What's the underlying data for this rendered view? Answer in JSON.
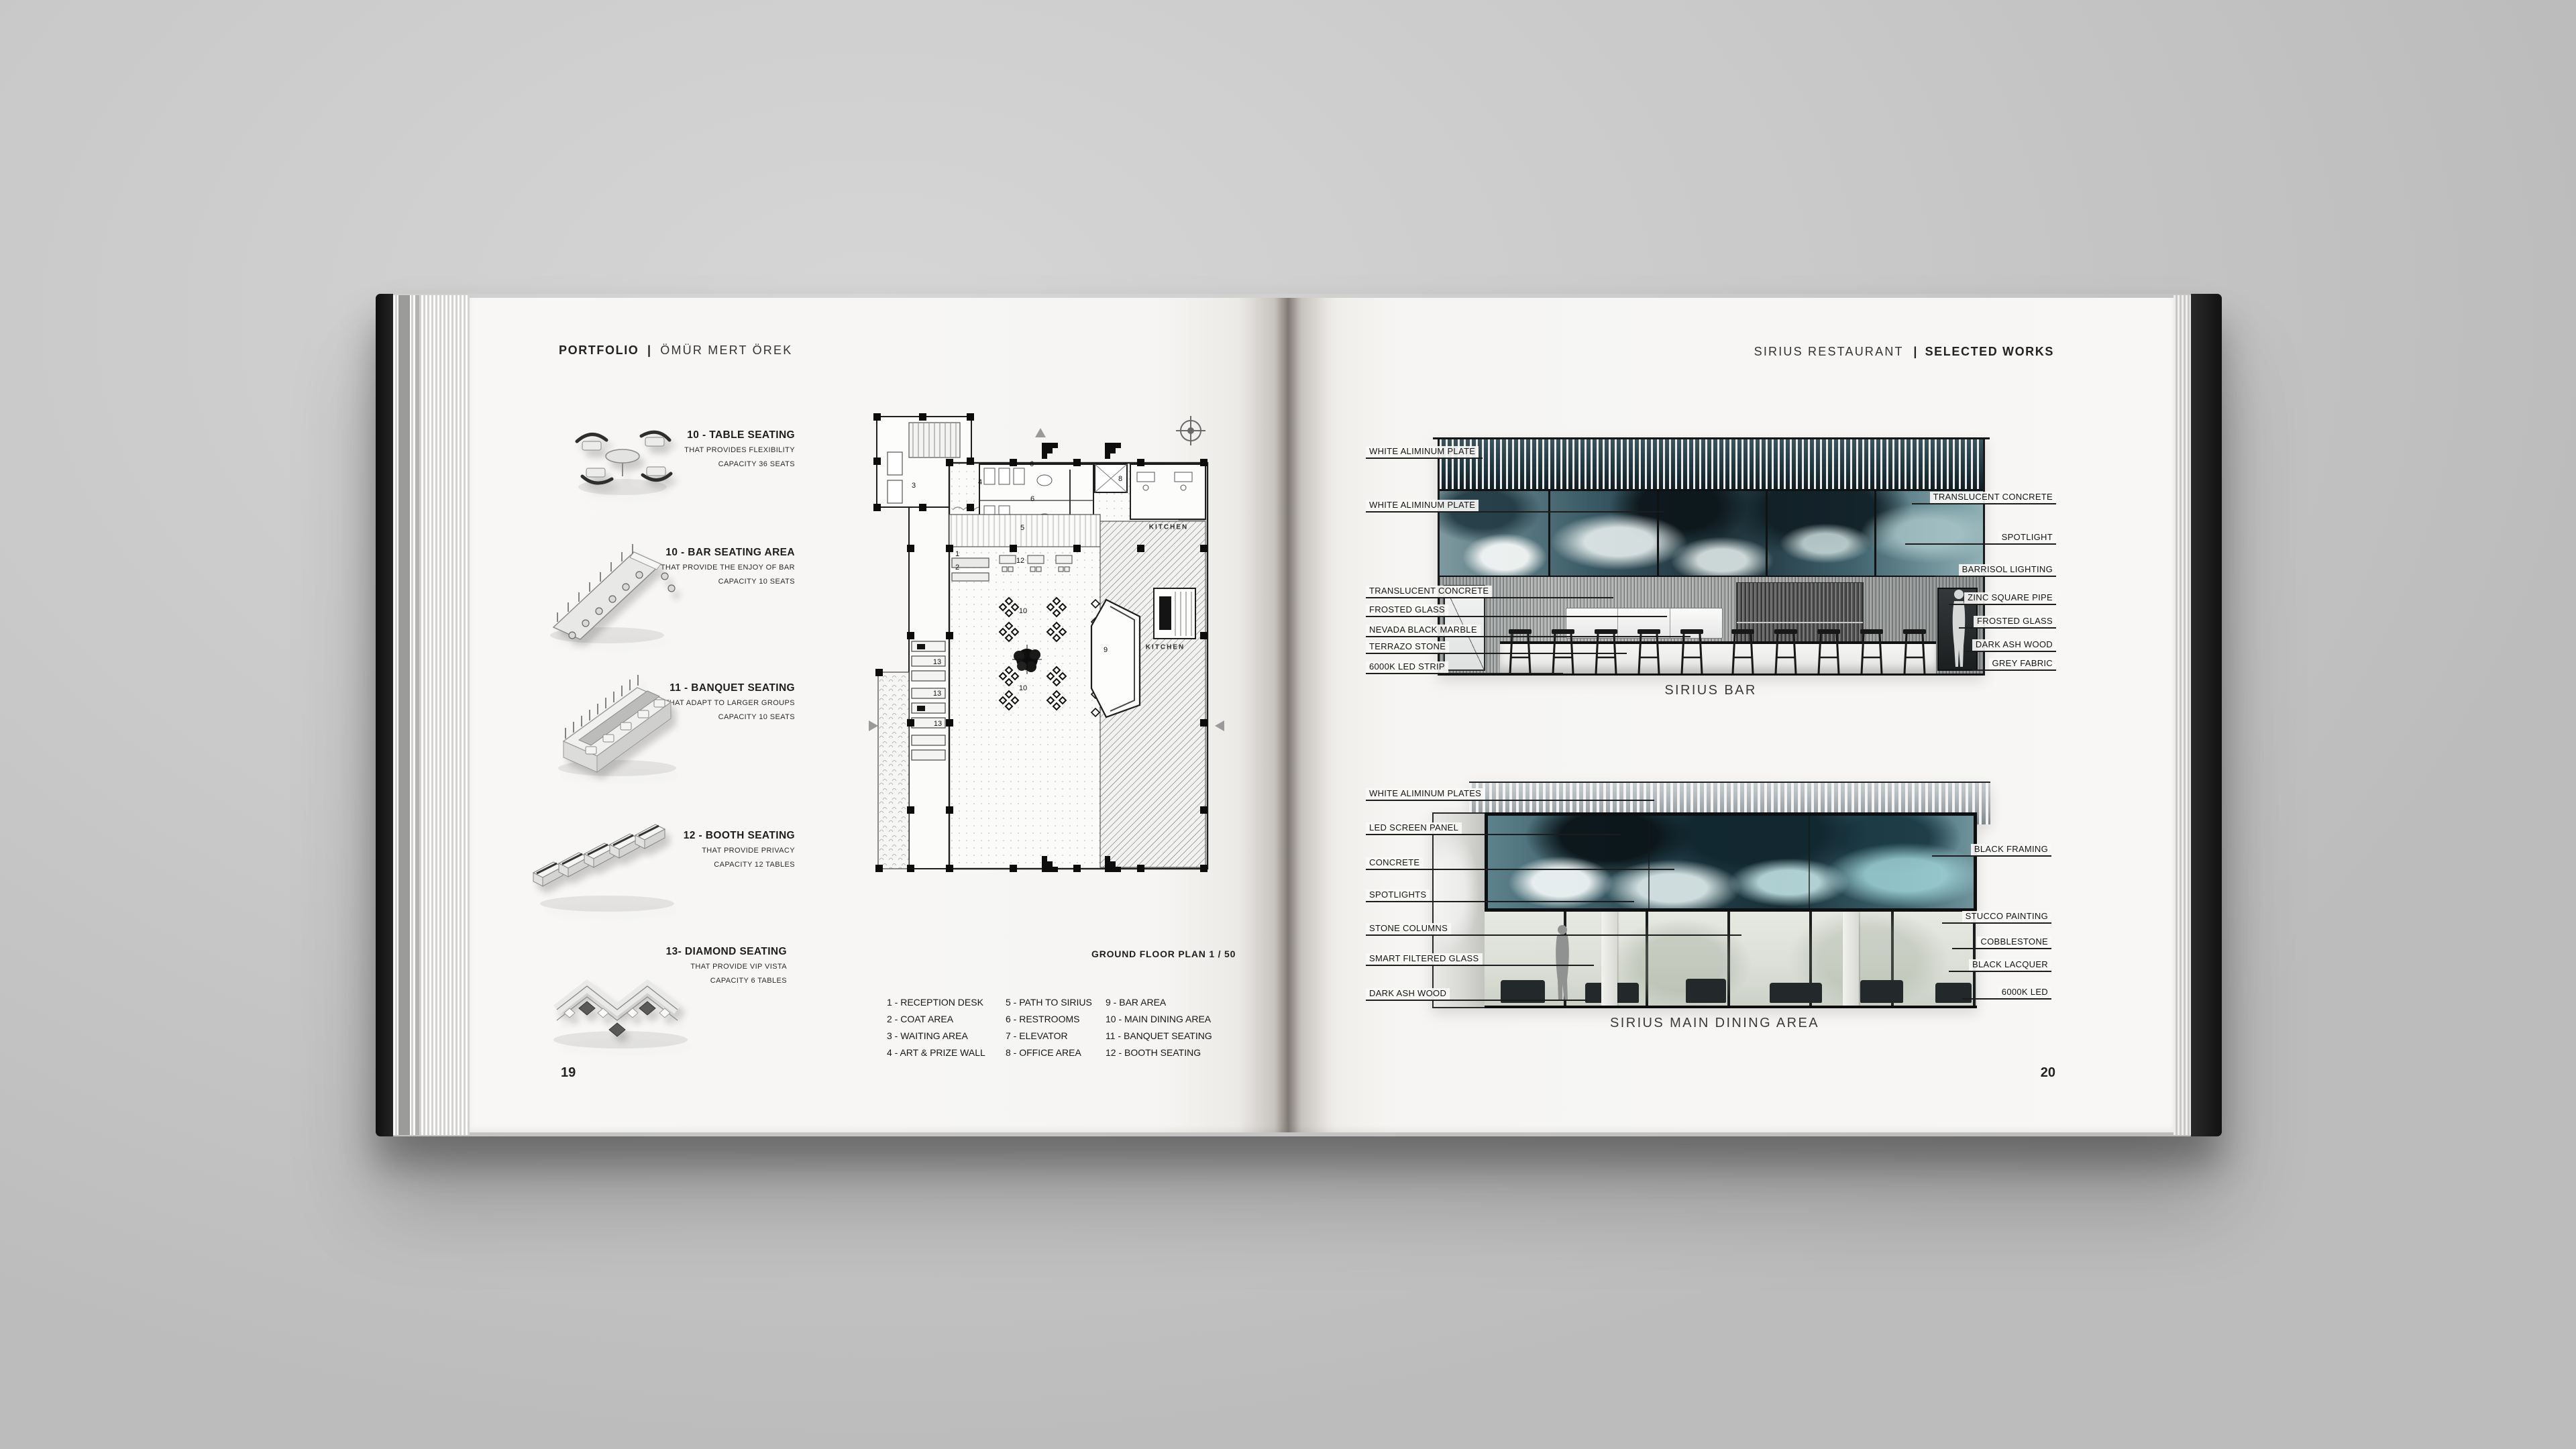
{
  "book": {
    "left_page_number": "19",
    "right_page_number": "20"
  },
  "left_page": {
    "header": {
      "title": "PORTFOLIO",
      "separator": "|",
      "author": "ÖMÜR MERT ÖREK"
    },
    "seating_items": [
      {
        "title": "10 - TABLE SEATING",
        "subtitle": "THAT PROVIDES FLEXIBILITY",
        "capacity": "CAPACITY 36 SEATS"
      },
      {
        "title": "10 - BAR SEATING AREA",
        "subtitle": "THAT PROVIDE THE ENJOY OF BAR",
        "capacity": "CAPACITY 10 SEATS"
      },
      {
        "title": "11 - BANQUET SEATING",
        "subtitle": "THAT ADAPT TO LARGER GROUPS",
        "capacity": "CAPACITY 10 SEATS"
      },
      {
        "title": "12 - BOOTH SEATING",
        "subtitle": "THAT PROVIDE PRIVACY",
        "capacity": "CAPACITY 12 TABLES"
      },
      {
        "title": "13- DIAMOND SEATING",
        "subtitle": "THAT PROVIDE VIP VISTA",
        "capacity": "CAPACITY 6 TABLES"
      }
    ],
    "floor_plan": {
      "caption": "GROUND FLOOR PLAN 1 / 50",
      "room_numbers": {
        "waiting": "3",
        "art_wall": "4",
        "restroom_top": "6",
        "restroom_bottom": "6",
        "elevator": "7",
        "office": "8",
        "path": "5",
        "reception": "1",
        "coat": "2",
        "booth_tables": "12",
        "dining_top": "10",
        "dining_bottom": "10",
        "bar": "9",
        "diamond_1": "13",
        "diamond_2": "13",
        "diamond_3": "13",
        "kitchen_top": "KITCHEN",
        "kitchen_bottom": "KITCHEN"
      },
      "legend": {
        "column_1": [
          "1 - RECEPTION DESK",
          "2 - COAT AREA",
          "3 - WAITING AREA",
          "4 - ART & PRIZE WALL"
        ],
        "column_2": [
          "5 - PATH TO SIRIUS",
          "6 - RESTROOMS",
          "7 - ELEVATOR",
          "8 - OFFICE AREA"
        ],
        "column_3": [
          "9 - BAR AREA",
          "10 - MAIN DINING AREA",
          "11 - BANQUET SEATING",
          "12 - BOOTH SEATING"
        ]
      }
    }
  },
  "right_page": {
    "header": {
      "project": "SIRIUS RESTAURANT",
      "separator": "|",
      "section": "SELECTED WORKS"
    },
    "bar_elevation": {
      "caption": "SIRIUS BAR",
      "left_labels": [
        "WHITE ALIMINUM PLATE",
        "WHITE ALIMINUM PLATE",
        "TRANSLUCENT CONCRETE",
        "FROSTED GLASS",
        "NEVADA BLACK MARBLE",
        "TERRAZO STONE",
        "6000K LED STRIP"
      ],
      "right_labels": [
        "TRANSLUCENT CONCRETE",
        "SPOTLIGHT",
        "BARRISOL LIGHTING",
        "ZINC SQUARE PIPE",
        "FROSTED GLASS",
        "DARK ASH WOOD",
        "GREY FABRIC"
      ]
    },
    "dining_elevation": {
      "caption": "SIRIUS MAIN DINING AREA",
      "left_labels": [
        "WHITE ALIMINUM PLATES",
        "LED SCREEN PANEL",
        "CONCRETE",
        "SPOTLIGHTS",
        "STONE COLUMNS",
        "SMART FILTERED GLASS",
        "DARK ASH WOOD"
      ],
      "right_labels": [
        "BLACK FRAMING",
        "STUCCO PAINTING",
        "COBBLESTONE",
        "BLACK LACQUER",
        "6000K LED"
      ]
    }
  },
  "colors": {
    "background": "#c9c9c9",
    "paper": "#f7f6f4",
    "ink": "#1c1c1c",
    "teal_dark": "#1c2f37",
    "teal_mid": "#4a707c",
    "teal_light": "#9dbec4",
    "cover": "#161616"
  }
}
